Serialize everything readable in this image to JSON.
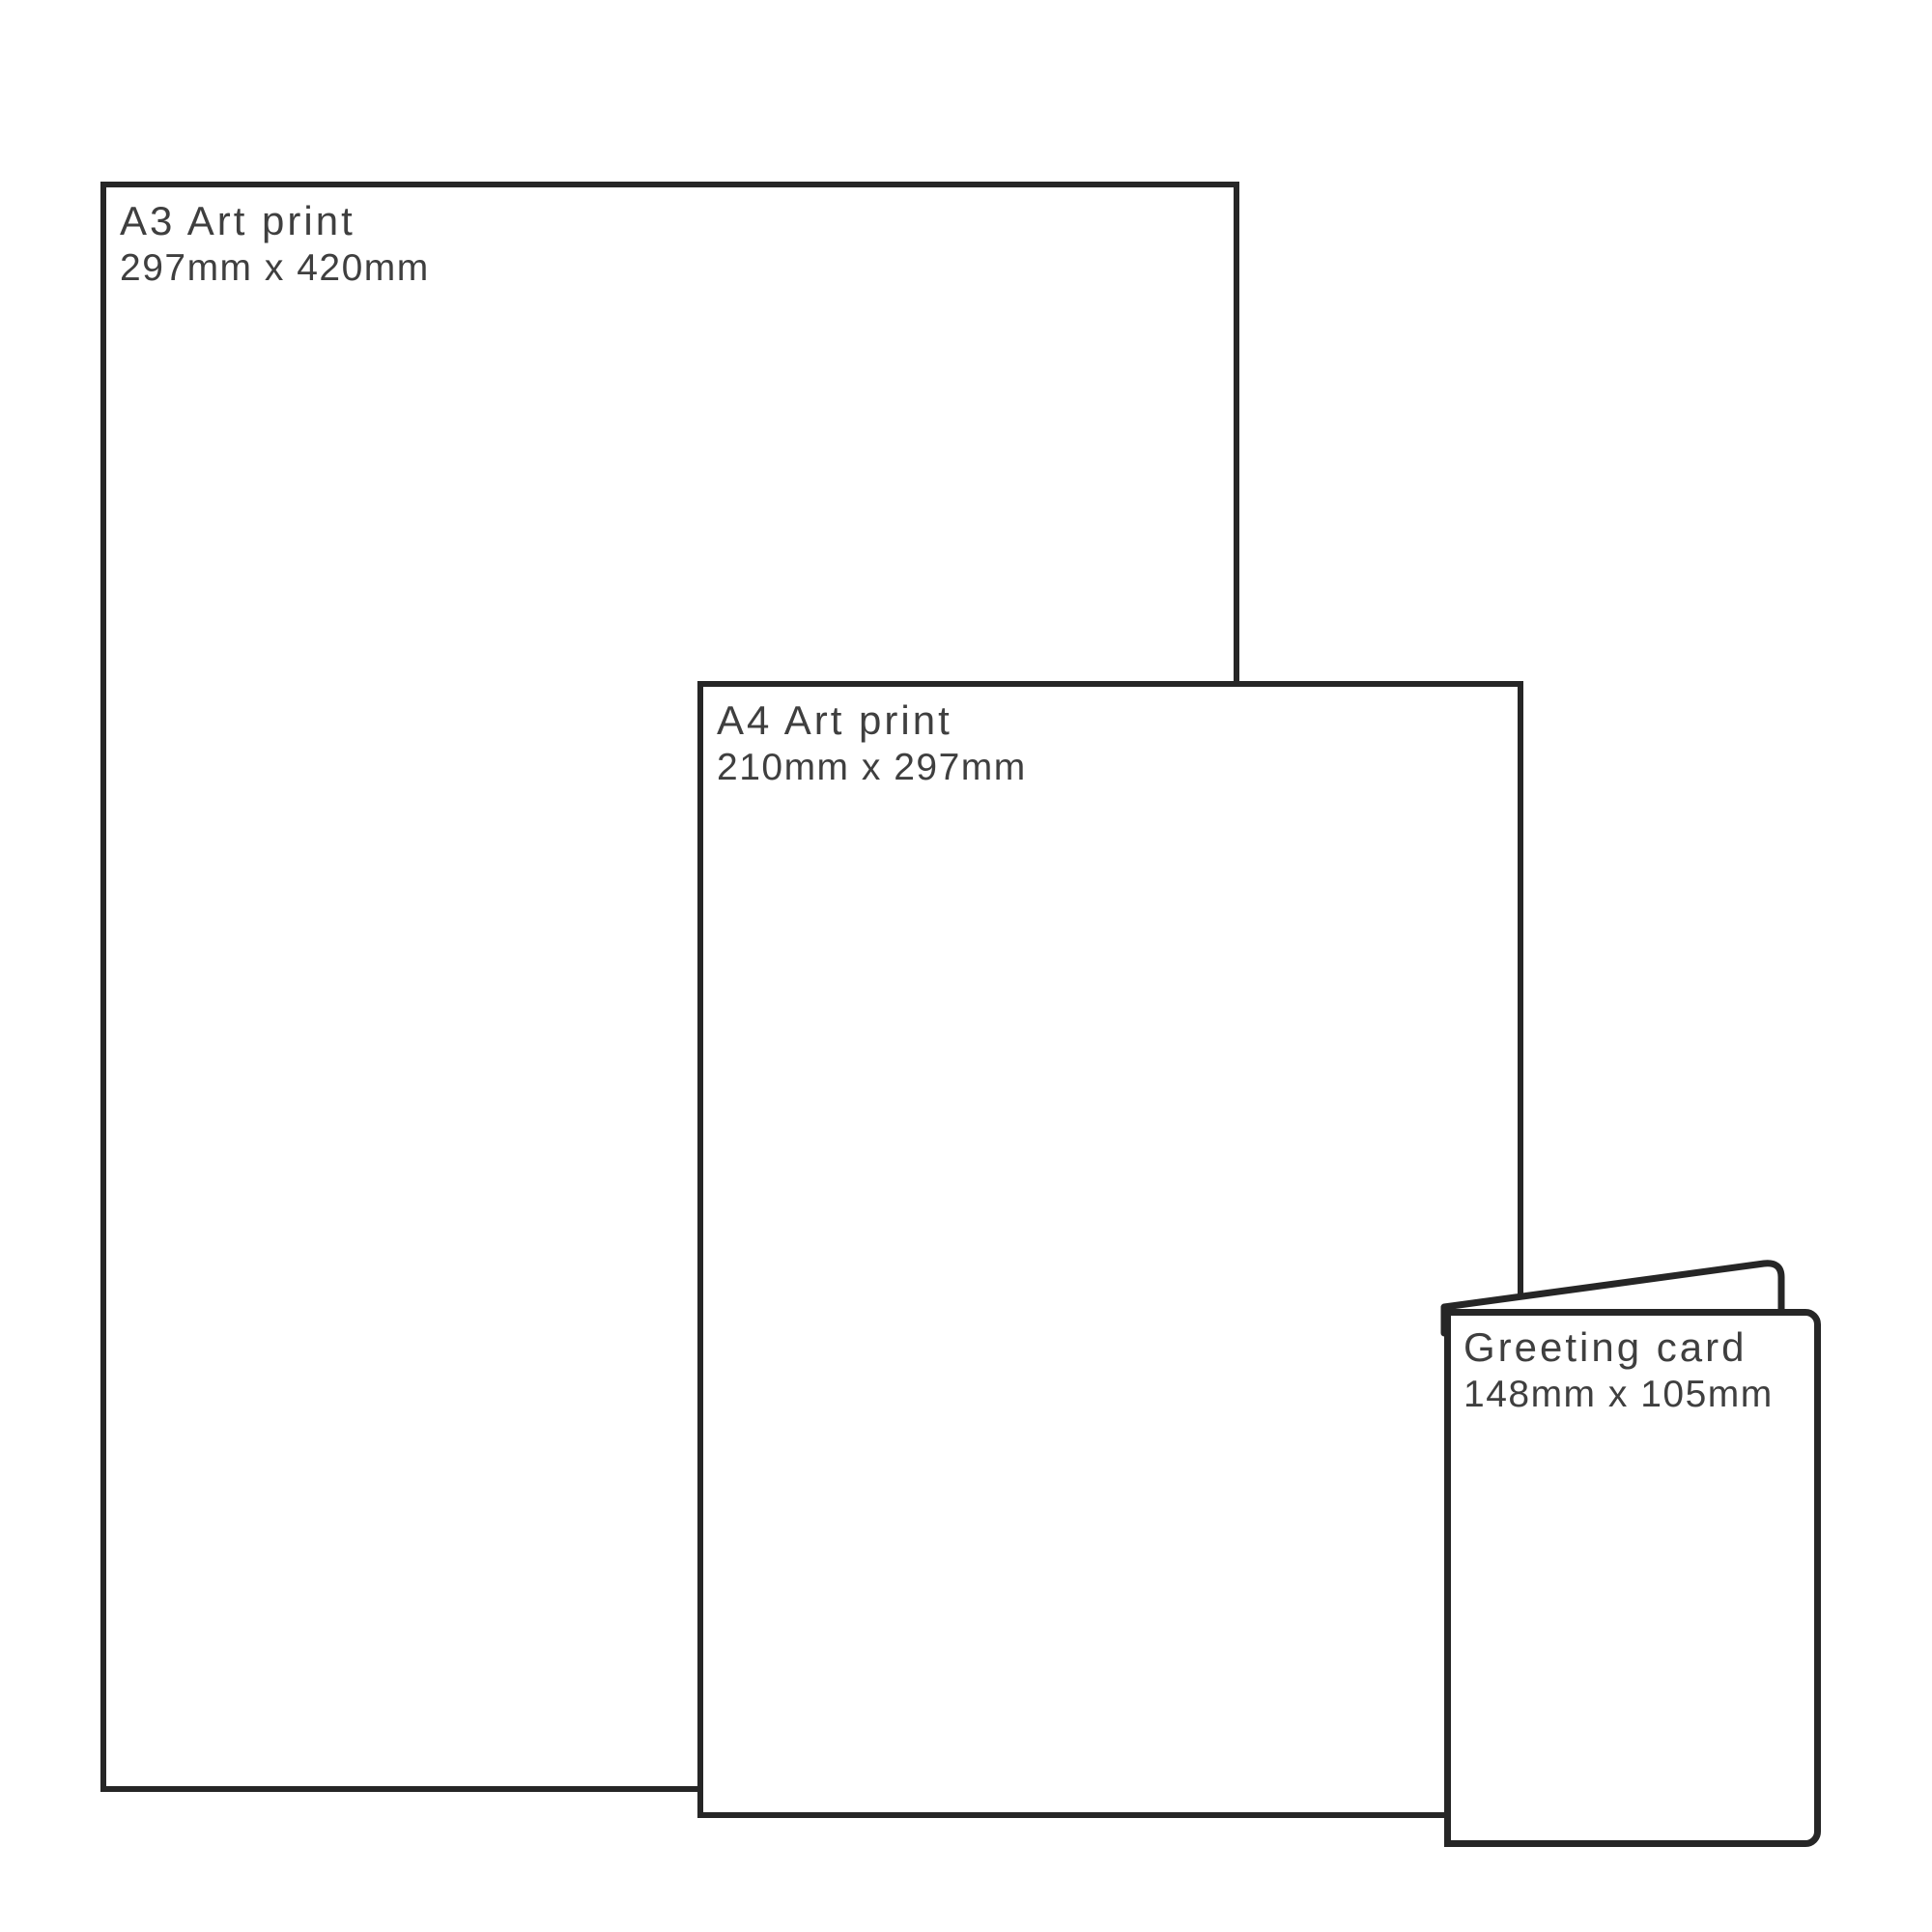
{
  "canvas": {
    "background_color": "#ffffff",
    "line_color": "#262626",
    "text_color": "#3f3f3f"
  },
  "items": [
    {
      "id": "a3",
      "title": "A3 Art print",
      "dimensions": "297mm x 420mm"
    },
    {
      "id": "a4",
      "title": "A4 Art print",
      "dimensions": "210mm x 297mm"
    },
    {
      "id": "card",
      "title": "Greeting card",
      "dimensions": "148mm x 105mm"
    }
  ]
}
